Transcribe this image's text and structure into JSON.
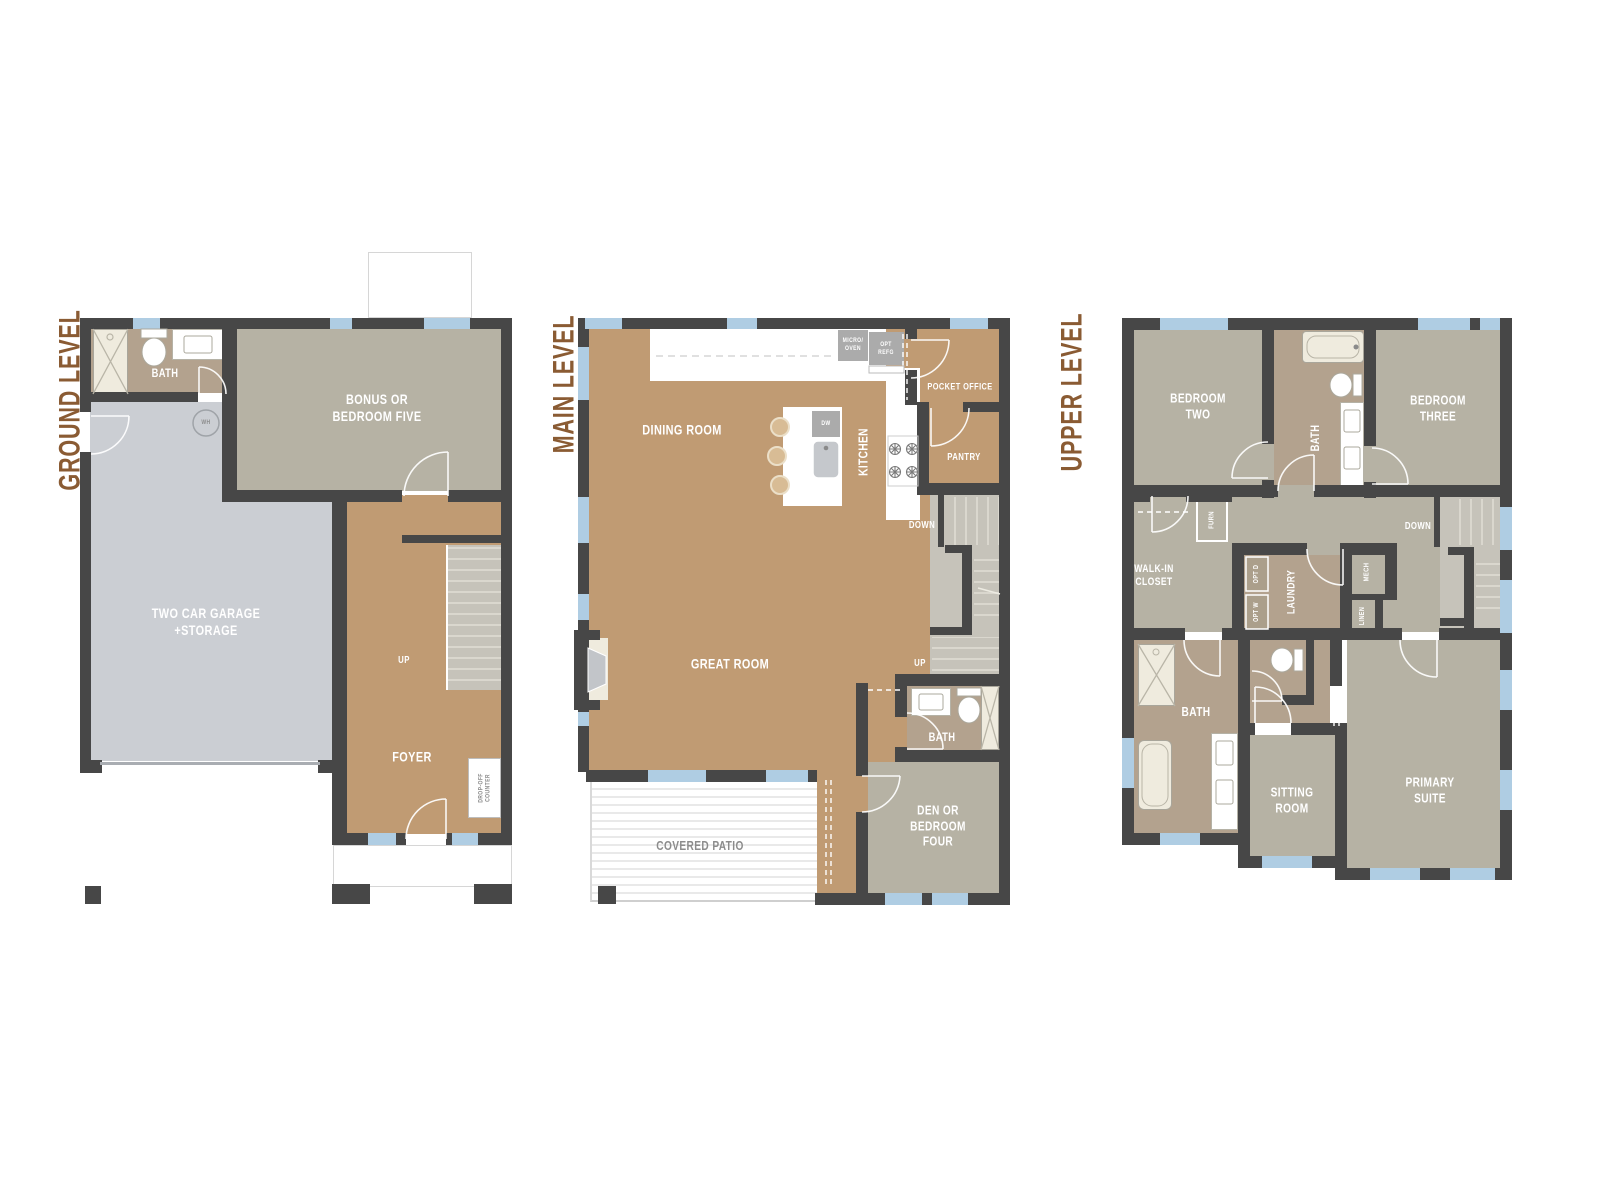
{
  "palette": {
    "wall": "#474747",
    "tan": "#C09B73",
    "taupe": "#B6B2A4",
    "bath": "#B3A28E",
    "garage": "#CBCED3",
    "window": "#AFCDE3",
    "cream": "#EFEBDE",
    "title_brown": "#8A5B33",
    "gray_label": "#8C8C8C",
    "stair": "#C6C3BA"
  },
  "ground": {
    "title": "GROUND LEVEL",
    "labels": {
      "bath": "BATH",
      "bonus": "BONUS OR\nBEDROOM FIVE",
      "garage": "TWO CAR GARAGE\n+STORAGE",
      "wh": "WH",
      "up": "UP",
      "foyer": "FOYER",
      "drop_off": "DROP-OFF\nCOUNTER"
    }
  },
  "main": {
    "title": "MAIN LEVEL",
    "labels": {
      "dining": "DINING ROOM",
      "kitchen": "KITCHEN",
      "micro": "MICRO/\nOVEN",
      "refg": "OPT\nREFG",
      "dw": "DW",
      "pocket": "POCKET OFFICE",
      "pantry": "PANTRY",
      "down": "DOWN",
      "great": "GREAT ROOM",
      "up": "UP",
      "bath": "BATH",
      "den": "DEN OR\nBEDROOM\nFOUR",
      "patio": "COVERED PATIO"
    }
  },
  "upper": {
    "title": "UPPER LEVEL",
    "labels": {
      "bed2": "BEDROOM\nTWO",
      "bath2": "BATH",
      "bed3": "BEDROOM\nTHREE",
      "furn": "FURN",
      "down": "DOWN",
      "walkin": "WALK-IN\nCLOSET",
      "optd": "OPT D",
      "optw": "OPT W",
      "laundry": "LAUNDRY",
      "mech": "MECH",
      "linen": "LINEN",
      "bath1": "BATH",
      "sitting": "SITTING\nROOM",
      "primary": "PRIMARY\nSUITE"
    }
  }
}
